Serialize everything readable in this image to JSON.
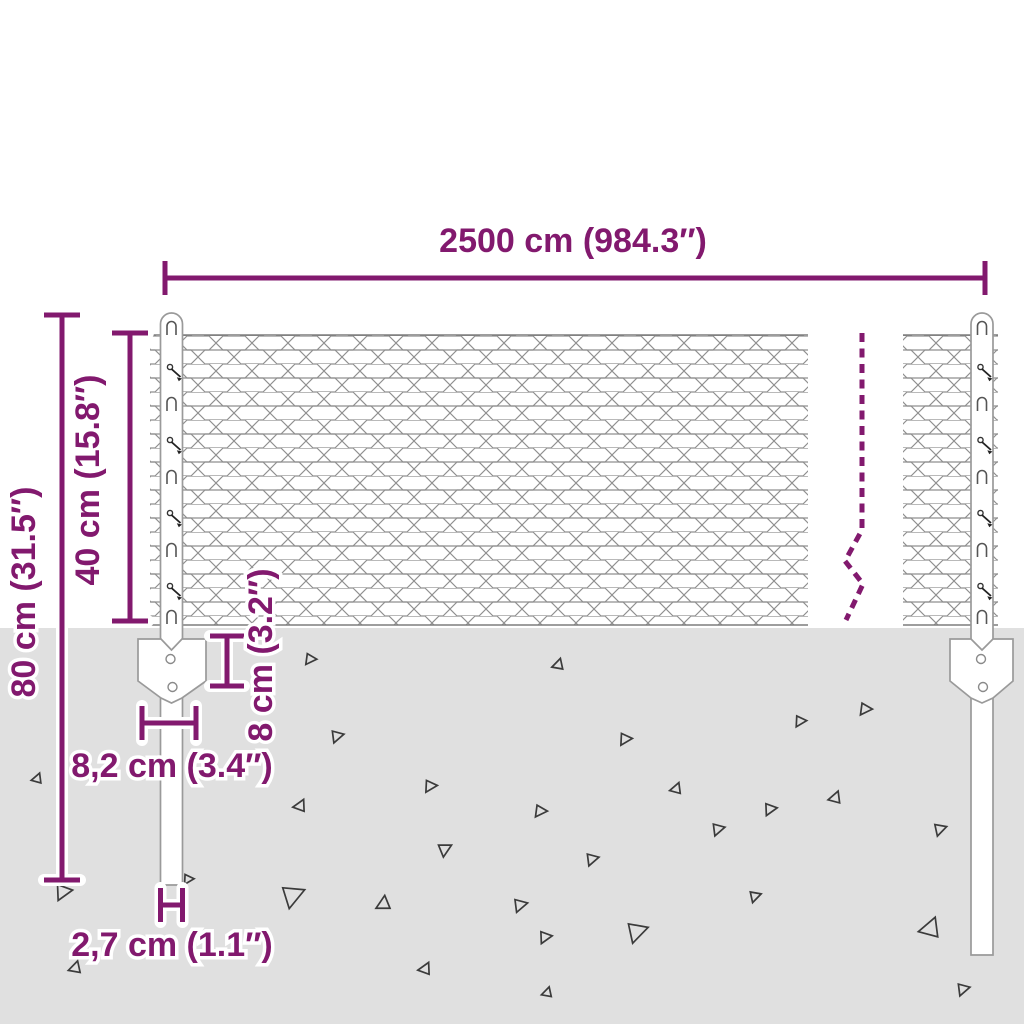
{
  "type": "product-dimension-diagram",
  "product": "chain-link mesh fence with steel posts and ground anchor plates",
  "colors": {
    "accent": "#82196e",
    "mesh_wire": "#8f8f8f",
    "ground": "#e0e0e0",
    "post": "#9a9a9a",
    "texture": "#3b3b3b"
  },
  "dimensions": {
    "fence_length": {
      "label": "2500 cm (984.3″)"
    },
    "total_post_height": {
      "label": "80 cm (31.5″)"
    },
    "mesh_height": {
      "label": "40 cm (15.8″)"
    },
    "anchor_plate_height": {
      "label": "8 cm (3.2″)"
    },
    "anchor_plate_width": {
      "label": "8,2 cm (3.4″)"
    },
    "post_diameter": {
      "label": "2,7 cm (1.1″)"
    }
  },
  "ground": {
    "triangles": [
      [
        37,
        778,
        10,
        15
      ],
      [
        63,
        893,
        16,
        200
      ],
      [
        75,
        967,
        12,
        10
      ],
      [
        188,
        880,
        10,
        205
      ],
      [
        293,
        897,
        22,
        185
      ],
      [
        310,
        660,
        11,
        210
      ],
      [
        337,
        737,
        12,
        195
      ],
      [
        300,
        805,
        12,
        20
      ],
      [
        383,
        903,
        14,
        0
      ],
      [
        430,
        787,
        12,
        205
      ],
      [
        445,
        850,
        13,
        180
      ],
      [
        520,
        906,
        13,
        195
      ],
      [
        545,
        938,
        12,
        200
      ],
      [
        558,
        664,
        11,
        10
      ],
      [
        540,
        812,
        12,
        210
      ],
      [
        592,
        860,
        12,
        195
      ],
      [
        625,
        740,
        12,
        205
      ],
      [
        637,
        933,
        20,
        190
      ],
      [
        676,
        788,
        11,
        15
      ],
      [
        718,
        830,
        12,
        195
      ],
      [
        755,
        897,
        11,
        190
      ],
      [
        770,
        810,
        12,
        200
      ],
      [
        800,
        722,
        11,
        205
      ],
      [
        835,
        797,
        12,
        15
      ],
      [
        865,
        710,
        12,
        210
      ],
      [
        930,
        927,
        20,
        15
      ],
      [
        940,
        830,
        12,
        190
      ],
      [
        425,
        968,
        12,
        20
      ],
      [
        963,
        990,
        12,
        195
      ],
      [
        547,
        992,
        10,
        10
      ]
    ]
  }
}
